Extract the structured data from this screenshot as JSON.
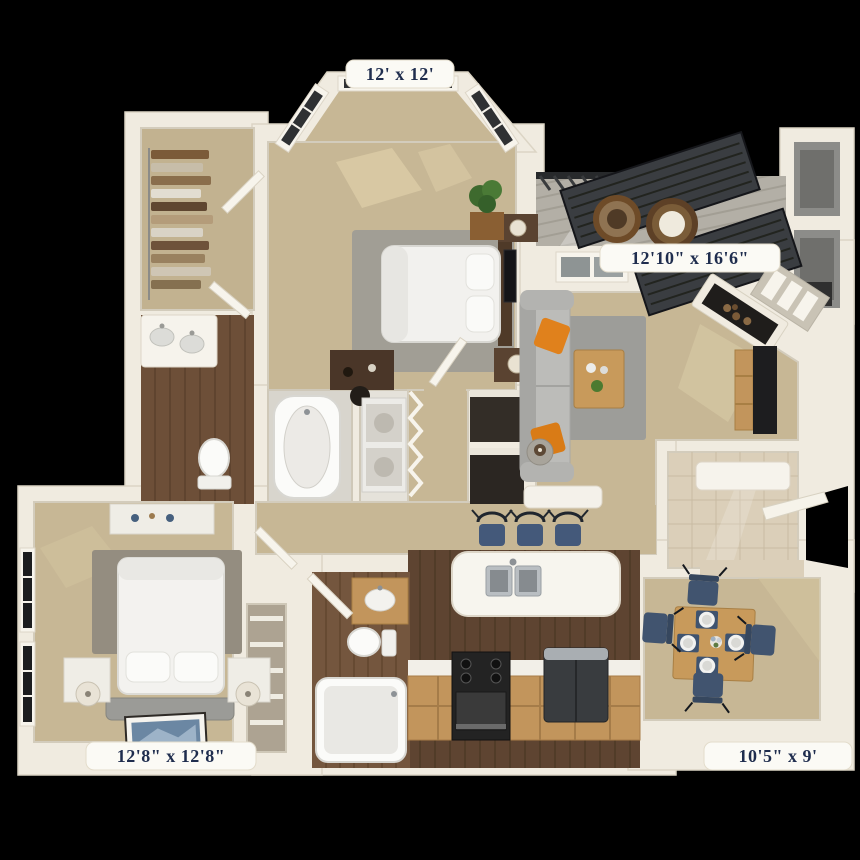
{
  "plan": {
    "dimension_labels": [
      {
        "room": "master-bedroom",
        "text": "12' x 12'"
      },
      {
        "room": "living-room",
        "text": "12'10\" x 16'6\""
      },
      {
        "room": "second-bedroom",
        "text": "12'8\" x 12'8\""
      },
      {
        "room": "dining-area",
        "text": "10'5\" x 9'"
      }
    ],
    "colors": {
      "background": "#000000",
      "walls": "#f0ebe0",
      "carpet": "#c7b795",
      "kitchen_wood": "#5e4431",
      "bath_wood": "#6d4f38",
      "balcony_deck": "#b3afa6",
      "label_text": "#1f2d4e",
      "label_pill": "#fbfaf5",
      "pillow_orange": "#e0811c",
      "seat_blue": "#44597a",
      "cabinet_wood": "#c2955c",
      "rug_gray": "#9d9d99"
    }
  }
}
